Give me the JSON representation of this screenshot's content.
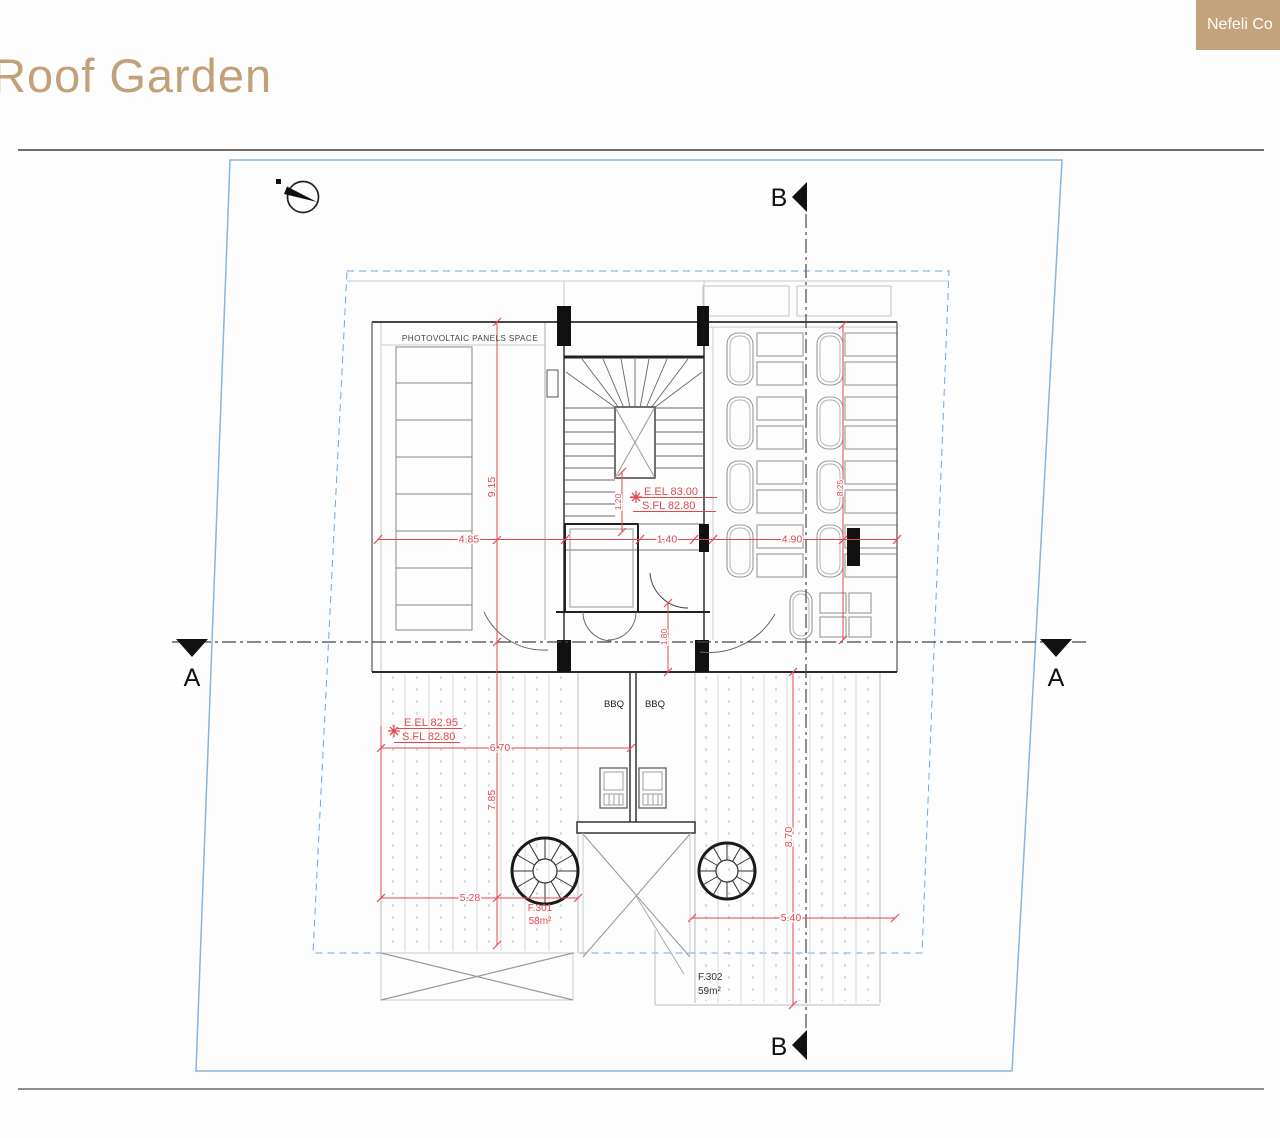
{
  "page": {
    "title": "Roof Garden",
    "badge_label": "Nefeli Co"
  },
  "colors": {
    "accent_tan": "#c2a179",
    "dim_red": "#e2494f",
    "boundary_blue": "#8ab4d8",
    "inner_boundary_blue": "#6fa8dc",
    "wall_black": "#1b1b1b"
  },
  "plan": {
    "section_a": "A",
    "section_b": "B",
    "labels": {
      "photovoltaic": "PHOTOVOLTAIC PANELS SPACE",
      "bbq_left": "BBQ",
      "bbq_right": "BBQ",
      "f301_name": "F.301",
      "f301_area": "58m²",
      "f302_name": "F.302",
      "f302_area": "59m²"
    },
    "elevations": {
      "upper_line1": "E.EL 83.00",
      "upper_line2": "S.FL 82.80",
      "lower_line1": "E.EL 82.95",
      "lower_line2": "S.FL 82.80"
    },
    "dims": {
      "roof_left_width": "4.85",
      "stair_width": "1.40",
      "roof_right_width": "4.90",
      "roof_left_height": "9.15",
      "deck_left_height": "7.85",
      "deck_width": "6.70",
      "f301_width": "5.28",
      "f302_width": "5.40",
      "deck_right_height": "8.70",
      "roof_right_height": "8.25",
      "stair_void": "1.20",
      "entry_depth": "1.80"
    }
  }
}
